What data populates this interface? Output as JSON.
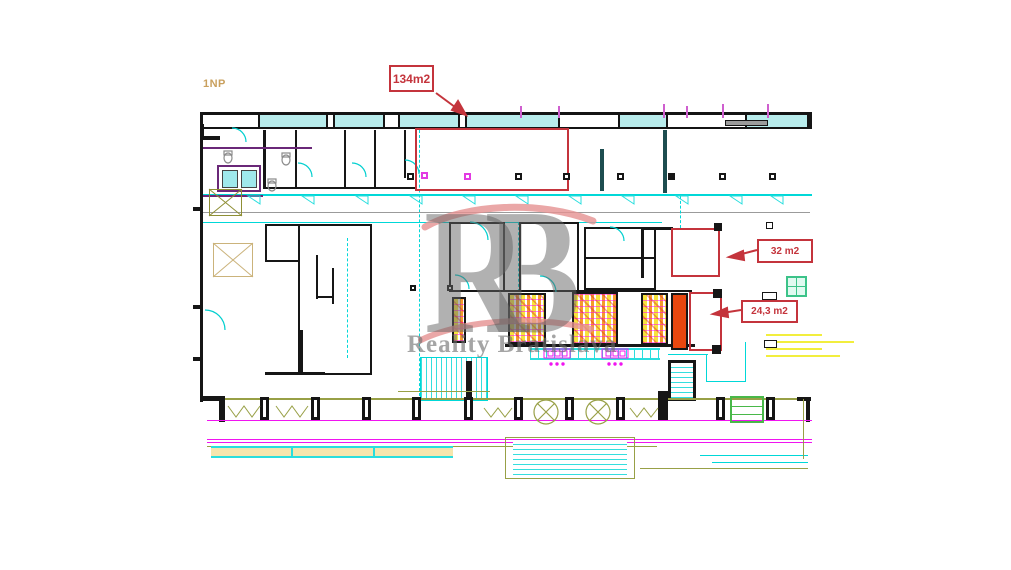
{
  "plan": {
    "floor_label": "1NP",
    "area_labels": [
      {
        "id": "134",
        "text": "134m2"
      },
      {
        "id": "32",
        "text": "32 m2"
      },
      {
        "id": "24_3",
        "text": "24,3 m2"
      }
    ]
  },
  "watermark": {
    "initials": "RB",
    "name": "Reality Bratislava"
  },
  "colors": {
    "annotation_red": "#c4343c",
    "wall_black": "#161616",
    "cad_cyan": "#00d8d8",
    "cad_magenta": "#f014f0",
    "cad_olive": "#98a046",
    "cad_yellow": "#f2ee3d",
    "stall_orange": "#e8470f",
    "floor_label_tan": "#c9a05e",
    "watermark_gray": "#6e6e6e",
    "watermark_pink": "#e59191"
  }
}
